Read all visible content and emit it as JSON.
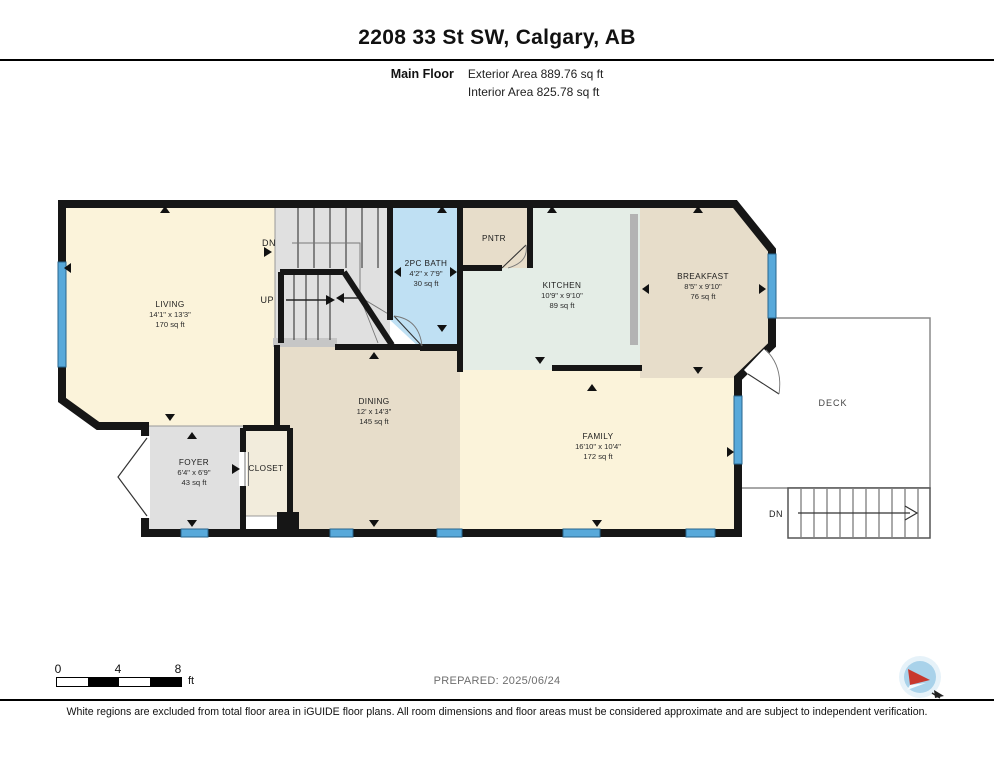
{
  "header": {
    "title": "2208 33 St SW, Calgary, AB",
    "floor_label": "Main Floor",
    "exterior_area": "Exterior Area 889.76 sq ft",
    "interior_area": "Interior Area 825.78 sq ft"
  },
  "rooms": {
    "living": {
      "name": "LIVING",
      "dims": "14'1\" x 13'3\"",
      "area": "170 sq ft"
    },
    "bath": {
      "name": "2PC BATH",
      "dims": "4'2\" x 7'9\"",
      "area": "30 sq ft"
    },
    "pantry": {
      "name": "PNTR"
    },
    "kitchen": {
      "name": "KITCHEN",
      "dims": "10'9\" x 9'10\"",
      "area": "89 sq ft"
    },
    "breakfast": {
      "name": "BREAKFAST",
      "dims": "8'5\" x 9'10\"",
      "area": "76 sq ft"
    },
    "dining": {
      "name": "DINING",
      "dims": "12' x 14'3\"",
      "area": "145 sq ft"
    },
    "family": {
      "name": "FAMILY",
      "dims": "16'10\" x 10'4\"",
      "area": "172 sq ft"
    },
    "foyer": {
      "name": "FOYER",
      "dims": "6'4\" x 6'9\"",
      "area": "43 sq ft"
    },
    "closet": {
      "name": "CLOSET"
    },
    "deck": {
      "name": "DECK"
    }
  },
  "stairs": {
    "up": "UP",
    "dn": "DN",
    "deck_dn": "DN"
  },
  "scale_bar": {
    "t0": "0",
    "t4": "4",
    "t8": "8",
    "unit": "ft"
  },
  "footer": {
    "prepared": "PREPARED: 2025/06/24",
    "disclaimer": "White regions are excluded from total floor area in iGUIDE floor plans. All room dimensions and floor areas must be considered approximate and are subject to independent verification."
  },
  "colors": {
    "room_cream": "#fbf3da",
    "room_tan": "#e7ddca",
    "room_mint": "#e4ede6",
    "room_blue": "#bfe0f3",
    "room_gray": "#e0e0e0",
    "wall": "#161616",
    "window_blue": "#58a9da",
    "logo_blue": "#a9d2ea",
    "logo_red": "#c8372d"
  }
}
